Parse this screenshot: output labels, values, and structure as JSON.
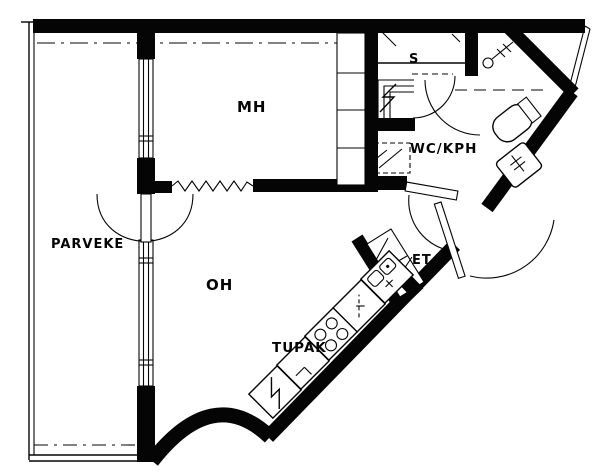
{
  "drawing_type": "apartment floor plan",
  "colors": {
    "ink": "#050505",
    "paper": "#ffffff"
  },
  "rooms": {
    "parveke": {
      "label": "PARVEKE"
    },
    "mh": {
      "label": "MH"
    },
    "oh": {
      "label": "OH"
    },
    "tupak": {
      "label": "TUPAK"
    },
    "wc_kph": {
      "label": "WC/KPH"
    },
    "et": {
      "label": "ET"
    },
    "sauna": {
      "label": "S"
    }
  },
  "fixtures": [
    "balcony-windows",
    "balcony-door",
    "bedroom-closets",
    "wall-break-zigzag",
    "sauna-benches",
    "sauna-heater",
    "sauna-door",
    "washing-machine-reservation",
    "shower-symbol",
    "toilet",
    "washbasin",
    "wc-door",
    "hall-closet",
    "entry-door",
    "refrigerator",
    "stove",
    "kitchen-counter",
    "kitchen-sink",
    "curved-exterior-wall",
    "corner-window"
  ]
}
